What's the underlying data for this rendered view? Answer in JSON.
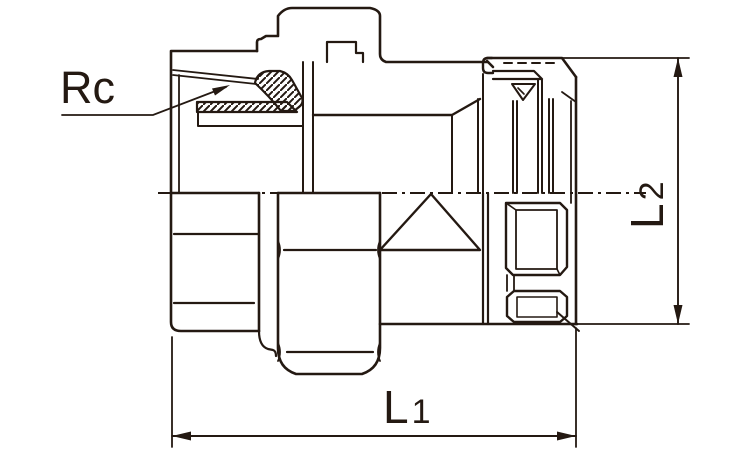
{
  "drawing": {
    "labels": {
      "thread": "Rc",
      "length": {
        "main": "L",
        "sub": "1"
      },
      "height": {
        "main": "L",
        "sub": "2"
      }
    },
    "colors": {
      "line": "#241912",
      "background": "#ffffff"
    }
  }
}
